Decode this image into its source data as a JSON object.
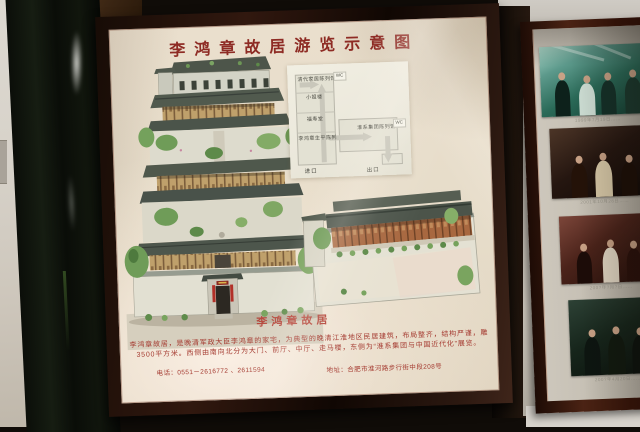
{
  "poster": {
    "title": "李鸿章故居游览示意图",
    "building_caption": "李鸿章故居",
    "description_lines": [
      "李鸿章故居，是晚清军政大臣李鸿章的家宅，为典型的晚清江淮地区民居建筑，布局整齐，结构严谨，雕梁画栋，占地面积",
      "3500平方米。西侧由南向北分为大门、前厅、中厅、走马楼，东侧为“淮系集团与中国近代化”展览。"
    ],
    "contact": {
      "phone": "电话：0551－2616772 、2611594",
      "address": "地址：合肥市淮河路步行街中段208号"
    },
    "route_map": {
      "stops": [
        "清代家居陈列馆",
        "小姐楼",
        "福寿堂",
        "李鸿章生平陈列"
      ],
      "east_hall": "淮系集团陈列馆",
      "wc_label": "WC",
      "entrance_label": "进口",
      "exit_label": "出口"
    }
  },
  "photo_panel": {
    "captions": [
      "1999年7月19日……",
      "2001年10月28日……",
      "200?年?月?日……",
      "200?年4月20日……"
    ]
  },
  "colors": {
    "title_red": "#8e2b24",
    "text_red": "#a53b31",
    "poster_cream": "#e8decc",
    "frame_black": "#1a0d07",
    "photo_frame_maroon": "#44200f",
    "illustration_green": "#6f9c58",
    "roof_gray": "#4e564c"
  }
}
